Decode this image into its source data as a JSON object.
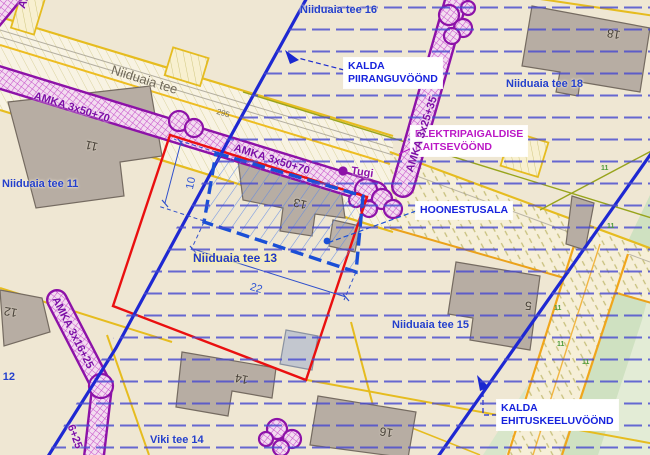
{
  "map": {
    "description_colors": {
      "ground": "#efe7d3",
      "plan_boundary_red": "#ea1010",
      "restriction_line_blue": "#1e28d2",
      "hoonestusala_blue": "#1a4fd6",
      "power_zone_purple": "#8d12a8",
      "road_border_yellow": "#e6bc1f",
      "road_border_orange": "#f0a61c",
      "hatch_row_blue": "#4a4ad0",
      "green_area": "#cfe1c1",
      "building_gray": "#b7ada3"
    },
    "labels": [
      {
        "name": "parcel-label-niiduaia-tee-16",
        "text": "Niiduaia tee 16",
        "x": 300,
        "y": 4,
        "rot": 0,
        "cls": "street"
      },
      {
        "name": "parcel-label-niiduaia-tee-18",
        "text": "Niiduaia tee 18",
        "x": 506,
        "y": 78,
        "rot": 0,
        "cls": "street"
      },
      {
        "name": "parcel-label-niiduaia-tee-11",
        "text": "Niiduaia tee 11",
        "x": 2,
        "y": 178,
        "rot": 0,
        "cls": "street"
      },
      {
        "name": "parcel-label-niiduaia-tee-13",
        "text": "Niiduaia tee 13",
        "x": 193,
        "y": 251,
        "rot": 0,
        "cls": "street-hl"
      },
      {
        "name": "parcel-label-niiduaia-tee-15",
        "text": "Niiduaia tee 15",
        "x": 392,
        "y": 319,
        "rot": 0,
        "cls": "street"
      },
      {
        "name": "parcel-label-niiduaia-tee-12",
        "text": "Niiduaia tee 12",
        "x": -62,
        "y": 371,
        "rot": 0,
        "cls": "street"
      },
      {
        "name": "parcel-label-viki-tee-14",
        "text": "Viki tee 14",
        "x": 150,
        "y": 434,
        "rot": 0,
        "cls": "street"
      },
      {
        "name": "road-name-niiduaia-tee",
        "text": "Niiduaia tee",
        "x": 114,
        "y": 62,
        "rot": 17.5,
        "cls": "roadname"
      },
      {
        "name": "callout-kalda-piiranguvoond",
        "text": "KALDA\nPIIRANGUVÖÖND",
        "x": 344,
        "y": 58,
        "rot": 0,
        "cls": "callout-blue"
      },
      {
        "name": "callout-elektripaigaldise-kaitsevoond",
        "text": "ELEKTRIPAIGALDISE\nKAITSEVÖÖND",
        "x": 411,
        "y": 126,
        "rot": 0,
        "cls": "callout-magenta"
      },
      {
        "name": "callout-hoonestusala",
        "text": "HOONESTUSALA",
        "x": 416,
        "y": 202,
        "rot": 0,
        "cls": "callout-blue"
      },
      {
        "name": "callout-kalda-ehituskeeluvoond",
        "text": "KALDA\nEHITUSKEELUVÖÖND",
        "x": 497,
        "y": 400,
        "rot": 0,
        "cls": "callout-blue"
      },
      {
        "name": "cable-label-amka-1",
        "text": "AMKA 3x50+70",
        "x": 36,
        "y": 90,
        "rot": 17.5,
        "cls": "amka"
      },
      {
        "name": "cable-label-amka-2",
        "text": "AMKA 3x50+70",
        "x": 236,
        "y": 142,
        "rot": 17.5,
        "cls": "amka"
      },
      {
        "name": "cable-label-amka-3",
        "text": "AMKA 3x25+35",
        "x": 404,
        "y": 170,
        "rot": -72,
        "cls": "amka"
      },
      {
        "name": "cable-label-amka-4",
        "text": "AMKA 3x16+25",
        "x": 60,
        "y": 295,
        "rot": 63,
        "cls": "amka"
      },
      {
        "name": "cable-label-amka-5",
        "text": "6+25",
        "x": 76,
        "y": 423,
        "rot": 70,
        "cls": "amka"
      },
      {
        "name": "cable-label-amka-partial",
        "text": "AM",
        "x": 16,
        "y": 6,
        "rot": -70,
        "cls": "amka"
      },
      {
        "name": "pole-label-tugi",
        "text": "Tugi",
        "x": 352,
        "y": 165,
        "rot": 8,
        "cls": "tugi"
      },
      {
        "name": "dimension-10",
        "text": "10",
        "x": 184,
        "y": 188,
        "rot": -78,
        "cls": "dim"
      },
      {
        "name": "dimension-22",
        "text": "22",
        "x": 252,
        "y": 281,
        "rot": 17,
        "cls": "dim"
      },
      {
        "name": "building-number-11",
        "text": "11",
        "x": 96,
        "y": 154,
        "rot": 193,
        "cls": "bnum"
      },
      {
        "name": "building-number-13",
        "text": "13",
        "x": 305,
        "y": 212,
        "rot": 193,
        "cls": "bnum"
      },
      {
        "name": "building-number-14",
        "text": "14",
        "x": 247,
        "y": 387,
        "rot": 190,
        "cls": "bnum"
      },
      {
        "name": "building-number-16",
        "text": "16",
        "x": 392,
        "y": 440,
        "rot": 188,
        "cls": "bnum"
      },
      {
        "name": "building-number-5",
        "text": "5",
        "x": 531,
        "y": 313,
        "rot": 185,
        "cls": "bnum"
      },
      {
        "name": "building-number-18",
        "text": "18",
        "x": 619,
        "y": 42,
        "rot": 190,
        "cls": "bnum"
      },
      {
        "name": "building-number-12",
        "text": "12",
        "x": 16,
        "y": 320,
        "rot": 190,
        "cls": "bnum"
      },
      {
        "name": "road-station-295",
        "text": "295",
        "x": 218,
        "y": 107,
        "rot": 17,
        "cls": "tick"
      },
      {
        "name": "veg-mark-1",
        "text": "11",
        "x": 601,
        "y": 165,
        "rot": 0,
        "cls": "veg"
      },
      {
        "name": "veg-mark-2",
        "text": "11",
        "x": 607,
        "y": 223,
        "rot": 0,
        "cls": "veg"
      },
      {
        "name": "veg-mark-3",
        "text": "11",
        "x": 554,
        "y": 305,
        "rot": 0,
        "cls": "veg"
      },
      {
        "name": "veg-mark-4",
        "text": "11",
        "x": 557,
        "y": 341,
        "rot": 0,
        "cls": "veg"
      },
      {
        "name": "veg-mark-5",
        "text": "11",
        "x": 582,
        "y": 359,
        "rot": 0,
        "cls": "veg"
      }
    ]
  }
}
